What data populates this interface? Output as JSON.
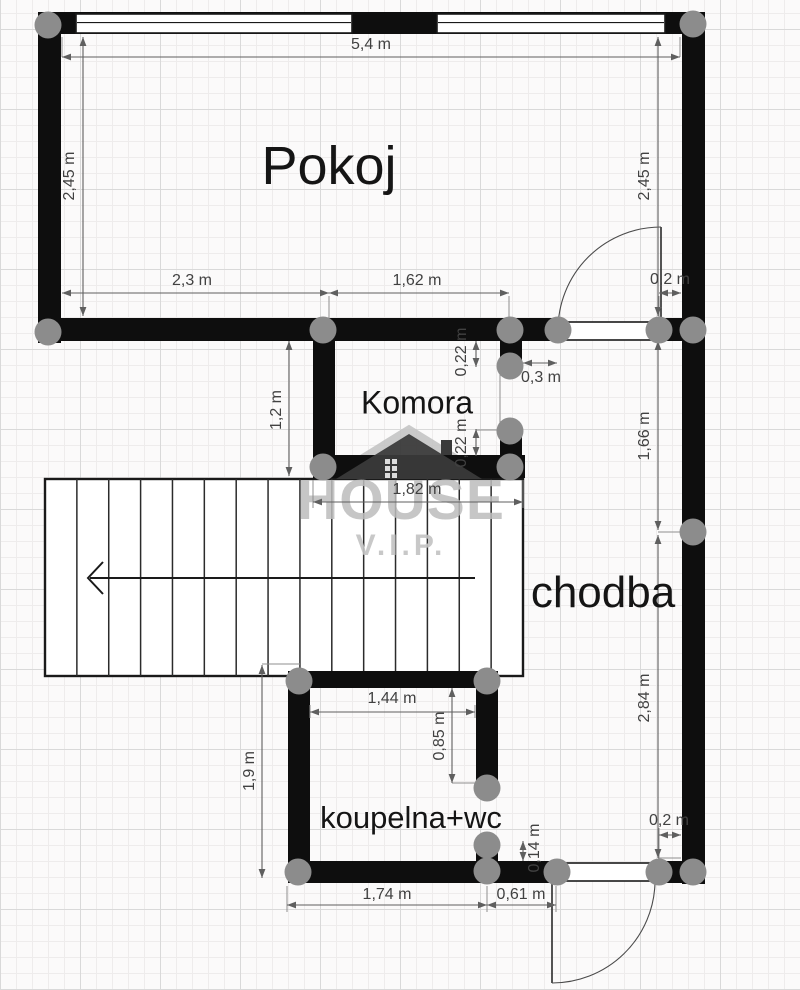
{
  "watermark": {
    "word": "HOUSE",
    "sub": "V.I.P."
  },
  "rooms": [
    {
      "name": "Pokoj",
      "x": 329,
      "y": 166,
      "size": 54
    },
    {
      "name": "Komora",
      "x": 417,
      "y": 403,
      "size": 32
    },
    {
      "name": "chodba",
      "x": 603,
      "y": 593,
      "size": 44
    },
    {
      "name": "koupelna+wc",
      "x": 411,
      "y": 818,
      "size": 31
    }
  ],
  "dimensions": [
    {
      "label": "5,4 m",
      "x1": 62,
      "y1": 57,
      "x2": 680,
      "y2": 57,
      "lx": 371,
      "ly": 45,
      "rot": false
    },
    {
      "label": "2,45 m",
      "x1": 83,
      "y1": 37,
      "x2": 83,
      "y2": 316,
      "lx": 70,
      "ly": 176,
      "rot": true
    },
    {
      "label": "2,45 m",
      "x1": 658,
      "y1": 37,
      "x2": 658,
      "y2": 316,
      "lx": 645,
      "ly": 176,
      "rot": true
    },
    {
      "label": "2,3 m",
      "x1": 62,
      "y1": 293,
      "x2": 329,
      "y2": 293,
      "lx": 192,
      "ly": 281,
      "rot": false
    },
    {
      "label": "1,62 m",
      "x1": 329,
      "y1": 293,
      "x2": 509,
      "y2": 293,
      "lx": 417,
      "ly": 281,
      "rot": false
    },
    {
      "label": "0,2 m",
      "x1": 659,
      "y1": 293,
      "x2": 681,
      "y2": 293,
      "lx": 670,
      "ly": 280,
      "rot": false
    },
    {
      "label": "0,22 m",
      "x1": 476,
      "y1": 341,
      "x2": 476,
      "y2": 367,
      "lx": 462,
      "ly": 352,
      "rot": true
    },
    {
      "label": "0,3 m",
      "x1": 523,
      "y1": 363,
      "x2": 557,
      "y2": 363,
      "lx": 541,
      "ly": 378,
      "rot": false
    },
    {
      "label": "1,2 m",
      "x1": 289,
      "y1": 341,
      "x2": 289,
      "y2": 476,
      "lx": 277,
      "ly": 410,
      "rot": true
    },
    {
      "label": "0,22 m",
      "x1": 476,
      "y1": 429,
      "x2": 476,
      "y2": 456,
      "lx": 462,
      "ly": 443,
      "rot": true
    },
    {
      "label": "1,82 m",
      "x1": 313,
      "y1": 502,
      "x2": 523,
      "y2": 502,
      "lx": 417,
      "ly": 490,
      "rot": false
    },
    {
      "label": "1,66 m",
      "x1": 658,
      "y1": 341,
      "x2": 658,
      "y2": 530,
      "lx": 645,
      "ly": 436,
      "rot": true
    },
    {
      "label": "2,84 m",
      "x1": 658,
      "y1": 535,
      "x2": 658,
      "y2": 858,
      "lx": 645,
      "ly": 698,
      "rot": true
    },
    {
      "label": "1,44 m",
      "x1": 310,
      "y1": 712,
      "x2": 475,
      "y2": 712,
      "lx": 392,
      "ly": 699,
      "rot": false
    },
    {
      "label": "0,85 m",
      "x1": 452,
      "y1": 688,
      "x2": 452,
      "y2": 783,
      "lx": 440,
      "ly": 736,
      "rot": true
    },
    {
      "label": "0,14 m",
      "x1": 523,
      "y1": 841,
      "x2": 523,
      "y2": 861,
      "lx": 535,
      "ly": 848,
      "rot": true
    },
    {
      "label": "1,9 m",
      "x1": 262,
      "y1": 665,
      "x2": 262,
      "y2": 878,
      "lx": 250,
      "ly": 771,
      "rot": true
    },
    {
      "label": "1,74 m",
      "x1": 287,
      "y1": 905,
      "x2": 487,
      "y2": 905,
      "lx": 387,
      "ly": 895,
      "rot": false
    },
    {
      "label": "0,61 m",
      "x1": 487,
      "y1": 905,
      "x2": 556,
      "y2": 905,
      "lx": 521,
      "ly": 895,
      "rot": false
    },
    {
      "label": "0,2 m",
      "x1": 659,
      "y1": 835,
      "x2": 681,
      "y2": 835,
      "lx": 669,
      "ly": 821,
      "rot": false
    }
  ],
  "extensions": [
    [
      62,
      37,
      62,
      57
    ],
    [
      680,
      37,
      680,
      57
    ],
    [
      329,
      296,
      329,
      318
    ],
    [
      509,
      296,
      509,
      318
    ],
    [
      659,
      296,
      659,
      318
    ],
    [
      500,
      367,
      500,
      430
    ],
    [
      476,
      430,
      508,
      430
    ],
    [
      452,
      783,
      476,
      783
    ],
    [
      313,
      480,
      313,
      508
    ],
    [
      523,
      480,
      523,
      508
    ],
    [
      310,
      705,
      310,
      718
    ],
    [
      475,
      705,
      475,
      718
    ],
    [
      287,
      886,
      287,
      912
    ],
    [
      487,
      886,
      487,
      912
    ],
    [
      556,
      886,
      556,
      912
    ],
    [
      262,
      664,
      300,
      664
    ],
    [
      658,
      532,
      681,
      532
    ],
    [
      658,
      858,
      681,
      858
    ],
    [
      659,
      828,
      659,
      861
    ]
  ],
  "walls": [
    [
      38,
      12,
      667,
      22
    ],
    [
      38,
      12,
      23,
      331
    ],
    [
      38,
      318,
      520,
      23
    ],
    [
      656,
      318,
      49,
      23
    ],
    [
      682,
      12,
      23,
      872
    ],
    [
      313,
      341,
      22,
      137
    ],
    [
      313,
      455,
      212,
      23
    ],
    [
      500,
      341,
      22,
      26
    ],
    [
      500,
      429,
      22,
      28
    ],
    [
      288,
      671,
      210,
      17
    ],
    [
      288,
      671,
      22,
      212
    ],
    [
      476,
      671,
      22,
      118
    ],
    [
      476,
      843,
      22,
      40
    ],
    [
      288,
      861,
      265,
      22
    ],
    [
      655,
      861,
      50,
      22
    ]
  ],
  "windows": [
    [
      76,
      14,
      276,
      19
    ],
    [
      437,
      14,
      228,
      19
    ]
  ],
  "sills": [
    [
      556,
      322,
      102,
      18
    ],
    [
      551,
      863,
      106,
      18
    ]
  ],
  "doors": [
    {
      "leaf": [
        661,
        330,
        661,
        227
      ],
      "arc": "M661,227 A103,103 0 0 0 558,330"
    },
    {
      "leaf": [
        552,
        883,
        552,
        983
      ],
      "arc": "M552,983 A103,103 0 0 0 655,883"
    }
  ],
  "stairs": {
    "x": 45,
    "y": 479,
    "w": 478,
    "h": 197,
    "steps": 14,
    "arrow": {
      "x1": 475,
      "y1": 578,
      "x2": 90,
      "y2": 578
    }
  },
  "junctions": [
    [
      48,
      25
    ],
    [
      693,
      24
    ],
    [
      48,
      332
    ],
    [
      323,
      330
    ],
    [
      510,
      330
    ],
    [
      558,
      330
    ],
    [
      659,
      330
    ],
    [
      693,
      330
    ],
    [
      510,
      366
    ],
    [
      510,
      431
    ],
    [
      323,
      467
    ],
    [
      510,
      467
    ],
    [
      693,
      532
    ],
    [
      299,
      681
    ],
    [
      487,
      681
    ],
    [
      487,
      788
    ],
    [
      487,
      845
    ],
    [
      487,
      871
    ],
    [
      298,
      872
    ],
    [
      557,
      872
    ],
    [
      659,
      872
    ],
    [
      693,
      872
    ]
  ],
  "colors": {
    "wall": "#0e0e0e",
    "dot": "#8c8c8c",
    "dim_line": "#5f5f5f",
    "ext_line": "#8f8f8f",
    "plan_line": "#2b2b2b",
    "roof": "#3a3a3a",
    "roof_outline": "#c4c4c4",
    "roof_window": "#dcdcdc"
  }
}
